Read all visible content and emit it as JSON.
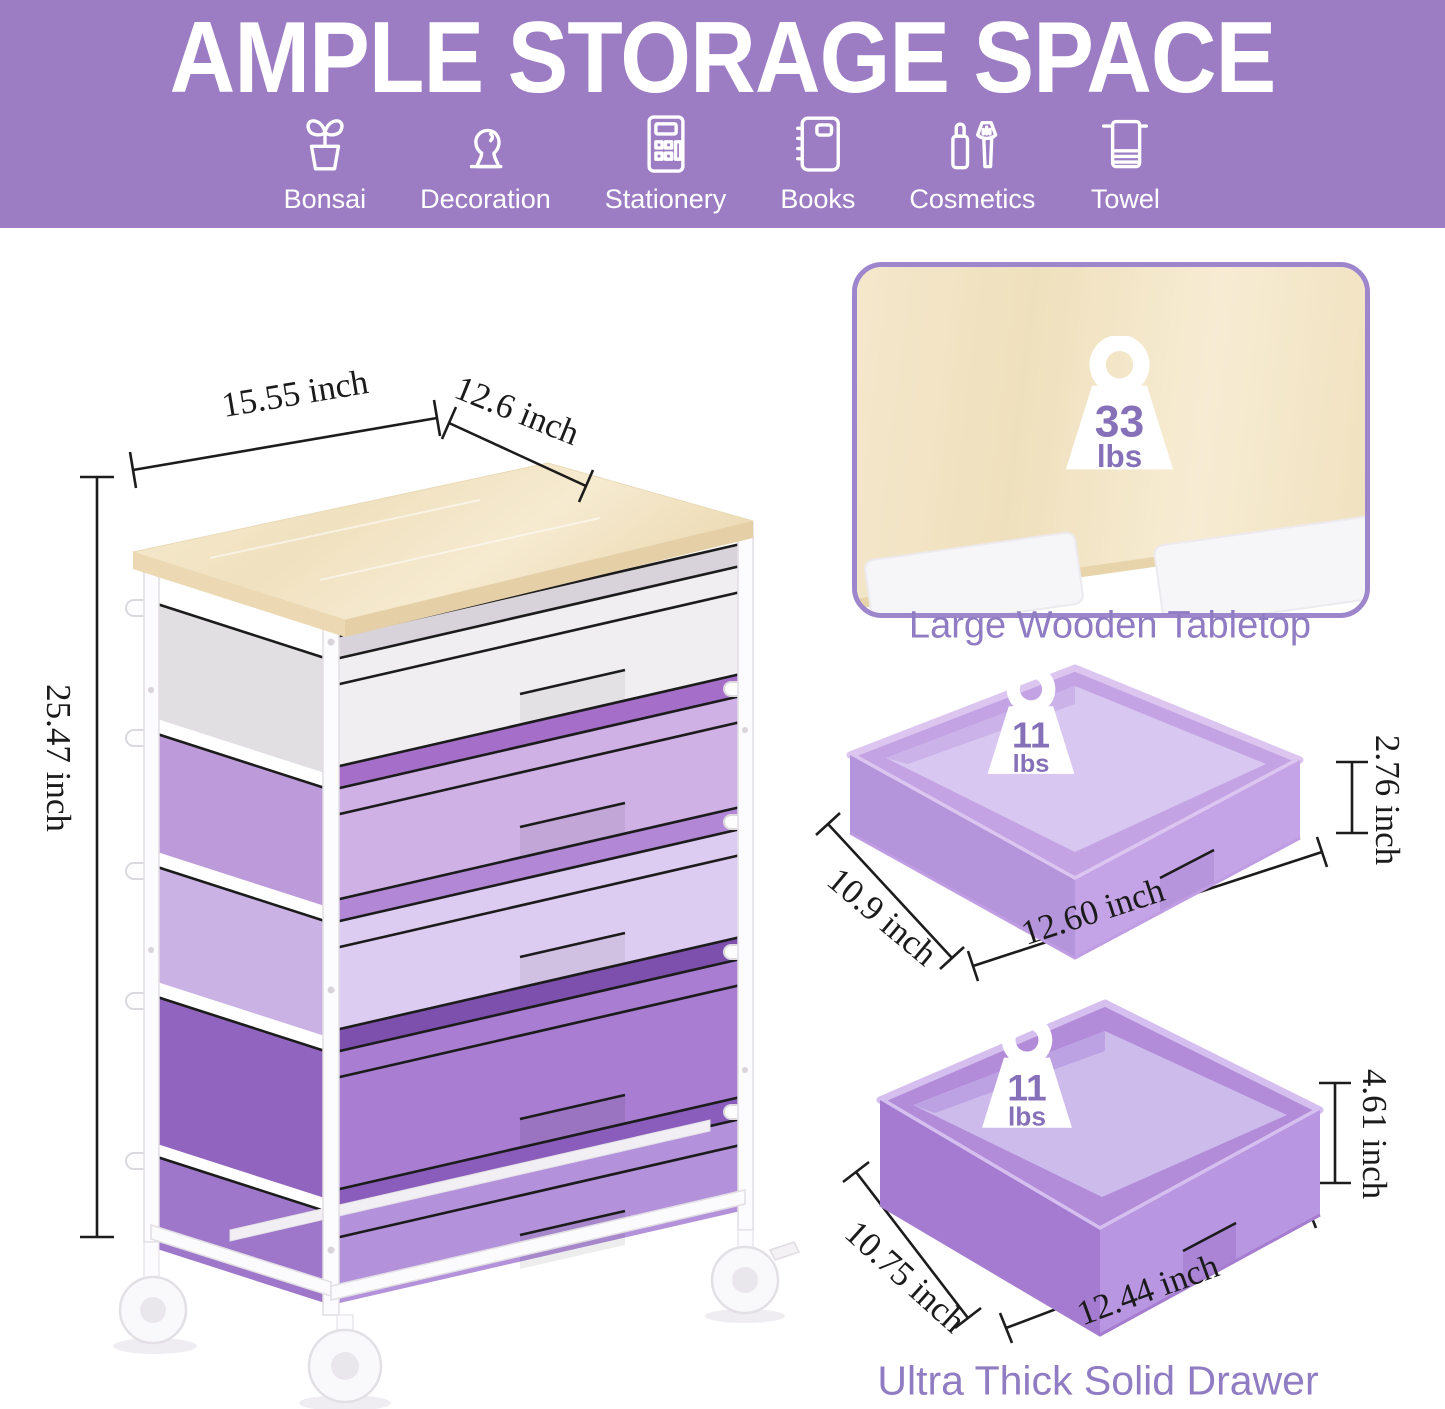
{
  "header": {
    "title": "AMPLE STORAGE SPACE",
    "categories": [
      {
        "label": "Bonsai",
        "icon": "bonsai-icon"
      },
      {
        "label": "Decoration",
        "icon": "decoration-icon"
      },
      {
        "label": "Stationery",
        "icon": "stationery-icon"
      },
      {
        "label": "Books",
        "icon": "books-icon"
      },
      {
        "label": "Cosmetics",
        "icon": "cosmetics-icon"
      },
      {
        "label": "Towel",
        "icon": "towel-icon"
      }
    ]
  },
  "cart": {
    "width_label": "15.55 inch",
    "depth_label": "12.6 inch",
    "height_label": "25.47 inch"
  },
  "tabletop": {
    "caption": "Large Wooden Tabletop",
    "capacity_value": "33",
    "capacity_unit": "lbs"
  },
  "shallow_drawer": {
    "capacity_value": "11",
    "capacity_unit": "lbs",
    "depth_label": "10.9 inch",
    "width_label": "12.60 inch",
    "height_label": "2.76 inch"
  },
  "deep_drawer": {
    "caption": "Ultra Thick Solid Drawer",
    "capacity_value": "11",
    "capacity_unit": "lbs",
    "depth_label": "10.75 inch",
    "width_label": "12.44 inch",
    "height_label": "4.61 inch"
  },
  "colors": {
    "banner_background": "#9c7dc4",
    "banner_text": "#ffffff",
    "caption_text": "#8f7cc2",
    "badge_number_text": "#8671b9",
    "panel_border": "#9d86cb",
    "dimension_text": "#1b1b1b",
    "wood": "#f3e4c6",
    "drawer_white": "#f0eef1",
    "drawer_light_purple": "#d0b1e6",
    "drawer_pale_lavender": "#ddccf1",
    "drawer_medium_purple": "#a87dd2",
    "drawer_purple": "#b392db"
  }
}
